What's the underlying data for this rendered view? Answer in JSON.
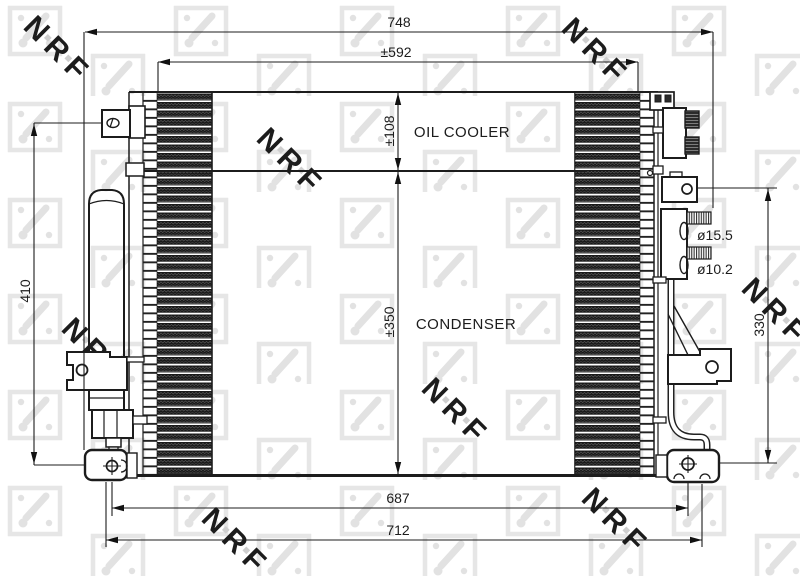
{
  "watermark": {
    "brand": "NRF"
  },
  "labels": {
    "oil_cooler": "OIL COOLER",
    "condenser": "CONDENSER"
  },
  "dims": {
    "overall_width": "748",
    "core_width": "±592",
    "oil_cooler_height": "±108",
    "condenser_height": "±350",
    "left_height": "410",
    "right_height": "330",
    "lower_mount_span": "687",
    "bracket_span": "712",
    "fitting_diameter_large": "ø15.5",
    "fitting_diameter_small": "ø10.2"
  }
}
